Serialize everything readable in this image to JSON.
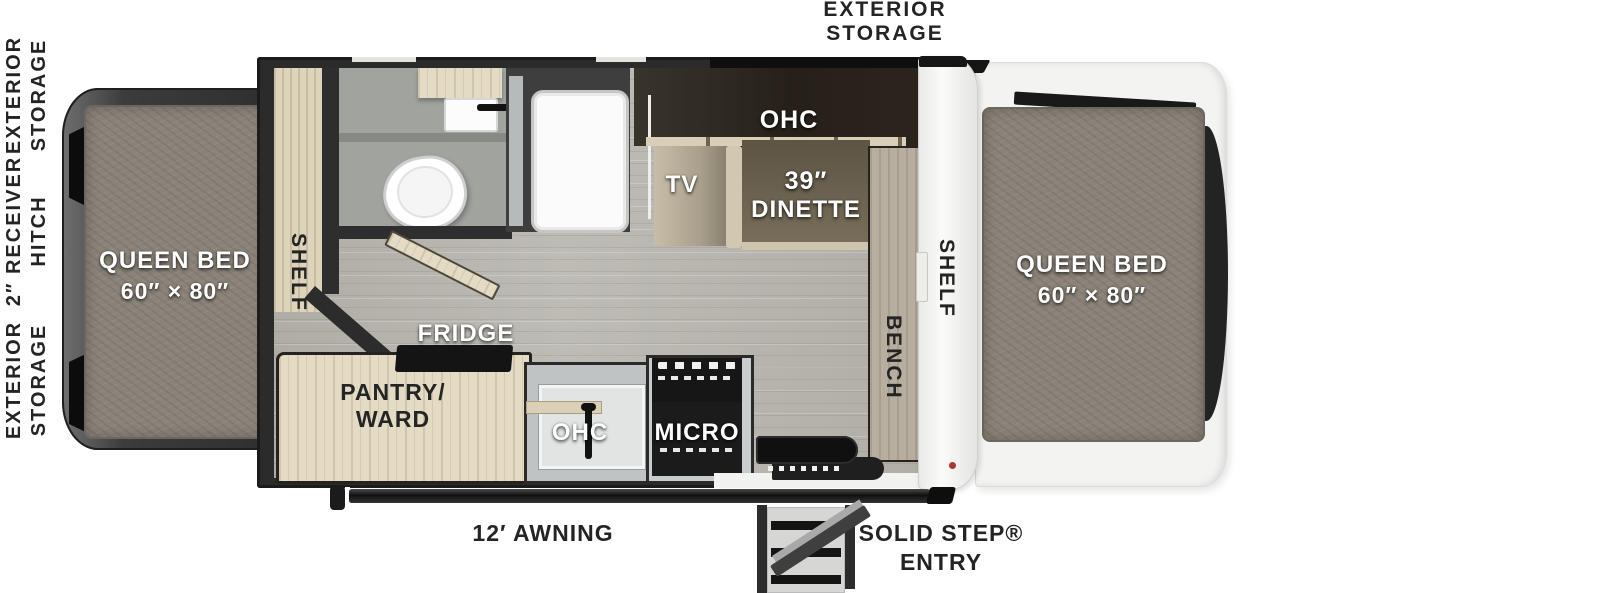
{
  "colors": {
    "wall_dark": "#2b2b2b",
    "floor_wood": "#b8b6af",
    "cabinet_wood": "#e4dbc5",
    "mattress_gray": "#8b8379",
    "bath_floor": "#a1a39f",
    "end_cap_white": "#f5f5f3",
    "dinette_brown": "#6b6152",
    "bench_tan": "#b7aea0",
    "accent_red_dot": "#a63a2c",
    "label_dark": "#242424",
    "label_light": "#ffffff"
  },
  "exterior": {
    "storage_top": {
      "line1": "EXTERIOR",
      "line2": "STORAGE"
    },
    "side_labels": [
      {
        "line1": "EXTERIOR",
        "line2": "STORAGE"
      },
      {
        "line1": "2″ RECEIVER",
        "line2": "HITCH"
      },
      {
        "line1": "EXTERIOR",
        "line2": "STORAGE"
      }
    ],
    "awning": "12′ AWNING",
    "entry_line1": "SOLID STEP®",
    "entry_line2": "ENTRY"
  },
  "interior": {
    "bed_left": {
      "name": "QUEEN BED",
      "size": "60″ × 80″"
    },
    "bed_right": {
      "name": "QUEEN BED",
      "size": "60″ × 80″"
    },
    "shelf_left": "SHELF",
    "shelf_right": "SHELF",
    "bench": "BENCH",
    "tv": "TV",
    "ohc": "OHC",
    "dinette_size": "39″",
    "dinette_name": "DINETTE",
    "fridge": "FRIDGE",
    "pantry_line1": "PANTRY/",
    "pantry_line2": "WARD",
    "kitchen_ohc": "OHC",
    "micro": "MICRO"
  }
}
